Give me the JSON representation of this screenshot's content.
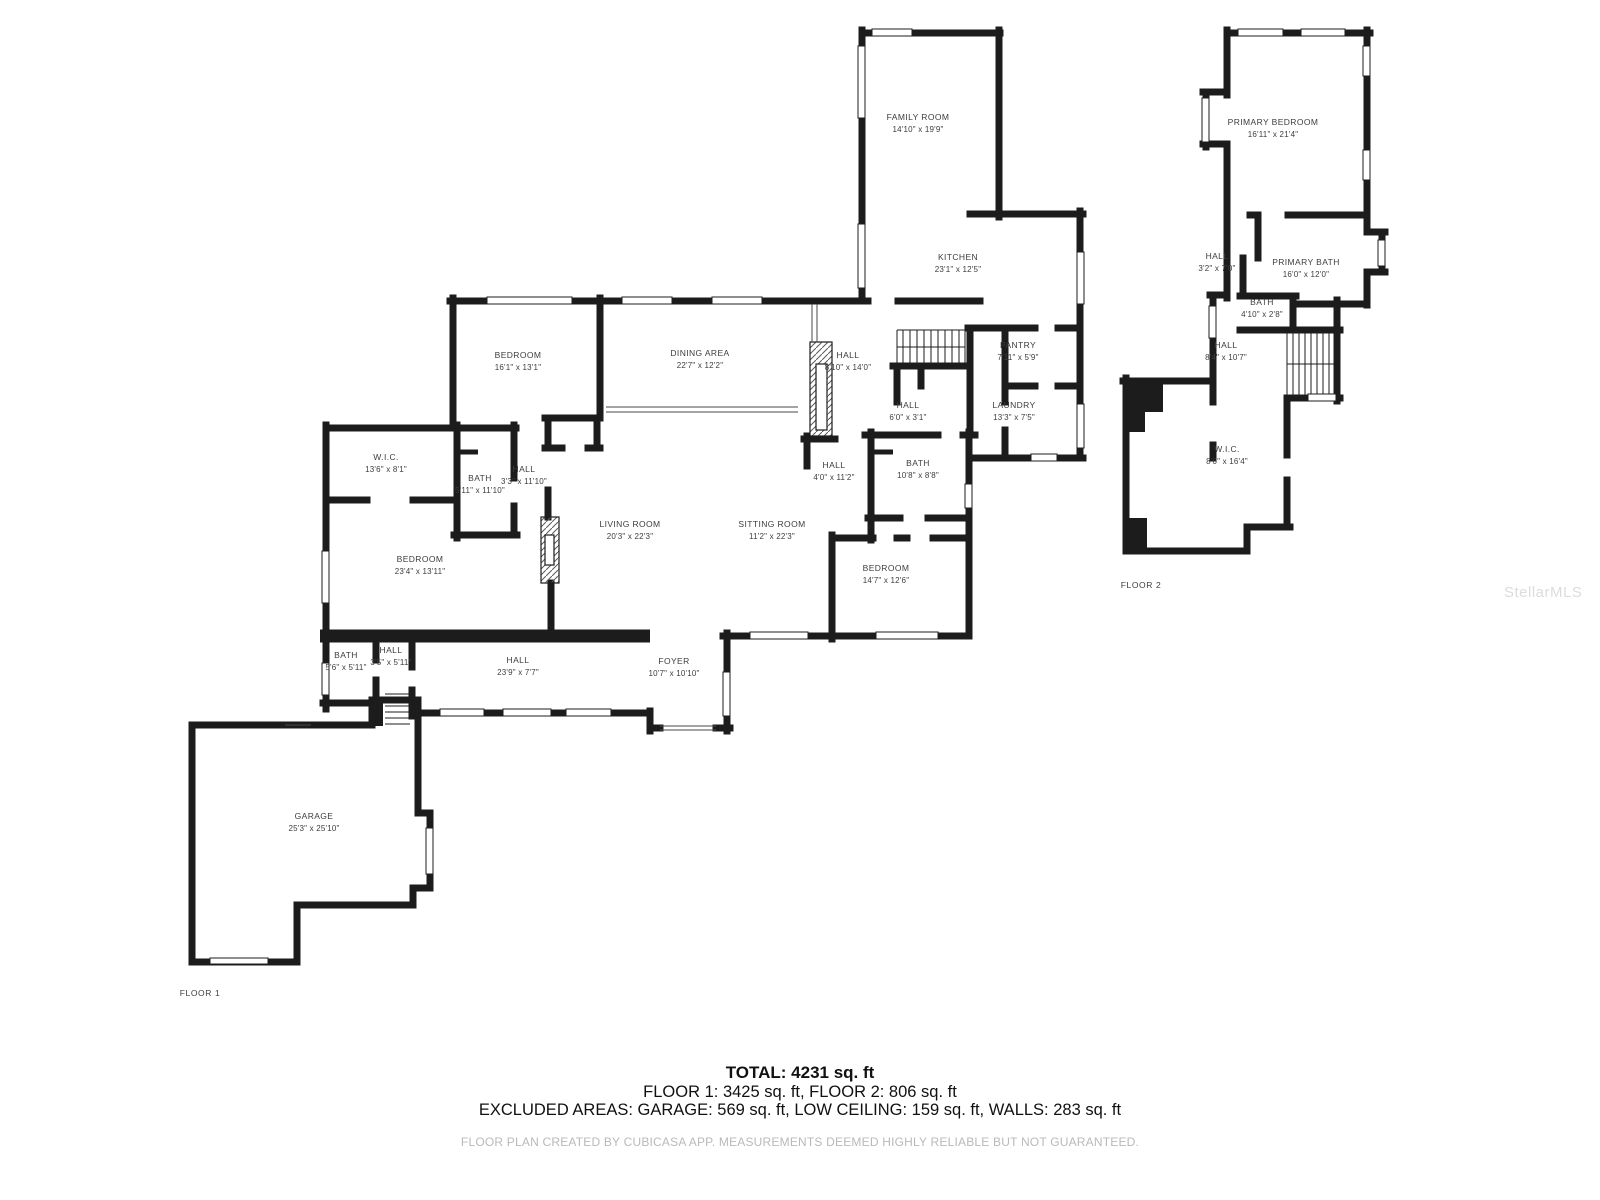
{
  "floor1": {
    "caption": "FLOOR 1",
    "rooms": [
      {
        "name": "FAMILY ROOM",
        "dims": "14'10\" x 19'9\""
      },
      {
        "name": "KITCHEN",
        "dims": "23'1\" x 12'5\""
      },
      {
        "name": "PANTRY",
        "dims": "7'11\" x 5'9\""
      },
      {
        "name": "LAUNDRY",
        "dims": "13'3\" x 7'5\""
      },
      {
        "name": "HALL",
        "dims": "8'10\" x 14'0\""
      },
      {
        "name": "HALL",
        "dims": "6'0\" x 3'1\""
      },
      {
        "name": "DINING AREA",
        "dims": "22'7\" x 12'2\""
      },
      {
        "name": "BEDROOM",
        "dims": "16'1\" x 13'1\""
      },
      {
        "name": "W.I.C.",
        "dims": "13'6\" x 8'1\""
      },
      {
        "name": "BATH",
        "dims": "5'11\" x 11'10\""
      },
      {
        "name": "HALL",
        "dims": "3'3\" x 11'10\""
      },
      {
        "name": "BEDROOM",
        "dims": "23'4\" x 13'11\""
      },
      {
        "name": "LIVING ROOM",
        "dims": "20'3\" x 22'3\""
      },
      {
        "name": "SITTING ROOM",
        "dims": "11'2\" x 22'3\""
      },
      {
        "name": "HALL",
        "dims": "4'0\" x 11'2\""
      },
      {
        "name": "BATH",
        "dims": "10'8\" x 8'8\""
      },
      {
        "name": "BEDROOM",
        "dims": "14'7\" x 12'6\""
      },
      {
        "name": "BATH",
        "dims": "5'6\" x 5'11\""
      },
      {
        "name": "HALL",
        "dims": "3'5\" x 5'11\""
      },
      {
        "name": "HALL",
        "dims": "23'9\" x 7'7\""
      },
      {
        "name": "FOYER",
        "dims": "10'7\" x 10'10\""
      },
      {
        "name": "GARAGE",
        "dims": "25'3\" x 25'10\""
      }
    ]
  },
  "floor2": {
    "caption": "FLOOR 2",
    "rooms": [
      {
        "name": "PRIMARY BEDROOM",
        "dims": "16'11\" x 21'4\""
      },
      {
        "name": "HALL",
        "dims": "3'2\" x 7'0\""
      },
      {
        "name": "PRIMARY BATH",
        "dims": "16'0\" x 12'0\""
      },
      {
        "name": "BATH",
        "dims": "4'10\" x 2'8\""
      },
      {
        "name": "HALL",
        "dims": "8'4\" x 10'7\""
      },
      {
        "name": "W.I.C.",
        "dims": "8'0\" x 16'4\""
      }
    ]
  },
  "summary": {
    "total": "TOTAL: 4231 sq. ft",
    "floors": "FLOOR 1: 3425 sq. ft, FLOOR 2: 806 sq. ft",
    "excluded": "EXCLUDED AREAS: GARAGE: 569 sq. ft, LOW CEILING: 159 sq. ft, WALLS: 283 sq. ft",
    "disclaimer": "FLOOR PLAN CREATED BY CUBICASA APP. MEASUREMENTS DEEMED HIGHLY RELIABLE BUT NOT GUARANTEED."
  },
  "watermark": "StellarMLS",
  "colors": {
    "wall": "#1c1c1c",
    "label": "#3d3d3d",
    "muted": "#b9b9b9",
    "watermark": "#dcdcdc"
  }
}
